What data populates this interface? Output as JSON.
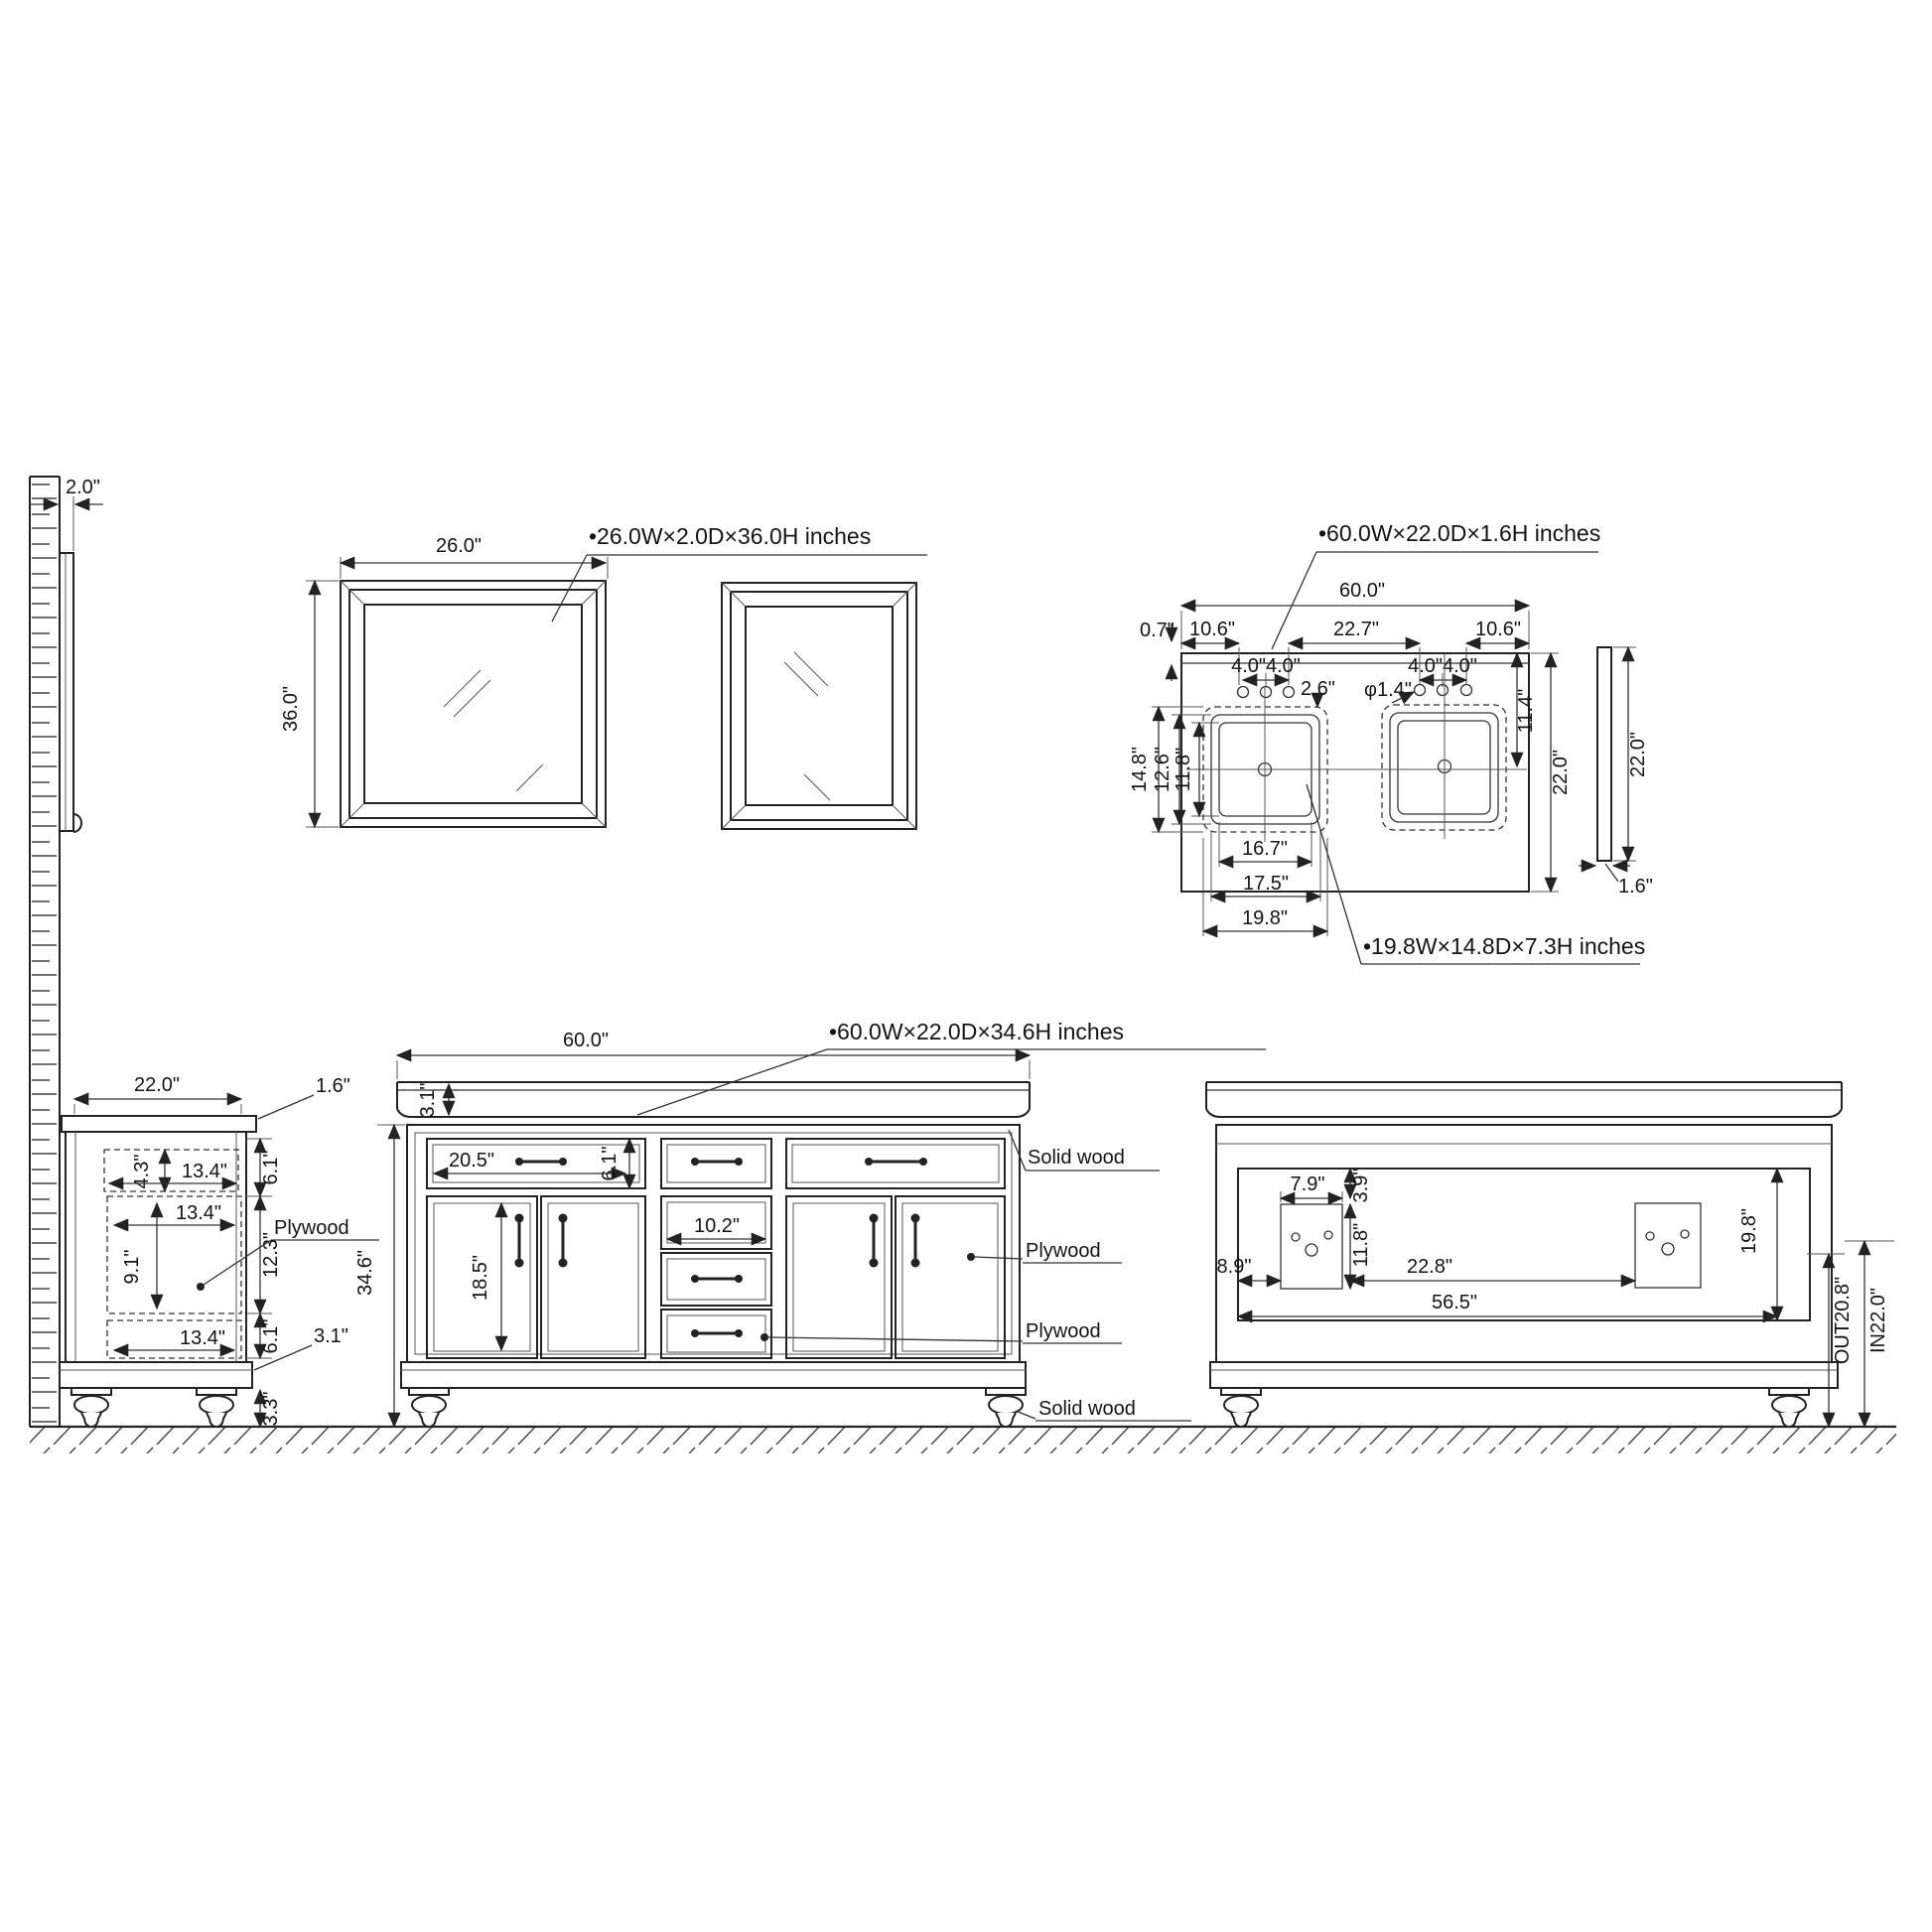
{
  "page": {
    "background": "#ffffff",
    "line_color": "#222222"
  },
  "views": {
    "wall": {
      "thickness": "2.0\""
    },
    "mirror_front": {
      "callout": "•26.0W×2.0D×36.0H inches",
      "width": "26.0\"",
      "height": "36.0\""
    },
    "countertop_plan": {
      "callout": "•60.0W×22.0D×1.6H inches",
      "width": "60.0\"",
      "back_ledge": "0.7\"",
      "left_to_holes": "10.6\"",
      "between_hole_groups": "22.7\"",
      "holes_to_right": "10.6\"",
      "hole_spacing_left": "4.0\"4.0\"",
      "hole_spacing_right": "4.0\"4.0\"",
      "hole_to_sink": "2.6\"",
      "hole_diameter": "φ1.4\"",
      "sink_setback": "11.4\"",
      "depth": "22.0\"",
      "sink_depth_outer": "14.8\"",
      "sink_depth_mid": "12.6\"",
      "sink_depth_inner": "11.8\"",
      "sink_width_inner": "16.7\"",
      "sink_width_mid": "17.5\"",
      "sink_width_outer": "19.8\"",
      "sink_callout": "•19.8W×14.8D×7.3H inches",
      "side_depth": "22.0\"",
      "side_thickness": "1.6\""
    },
    "side_view": {
      "depth": "22.0\"",
      "counter_thickness": "1.6\"",
      "drawer_height": "4.3\"",
      "drawer_width": "13.4\"",
      "mid_width": "13.4\"",
      "mid_inner_height": "9.1\"",
      "bottom_width": "13.4\"",
      "top_section": "6.1\"",
      "mid_section": "12.3\"",
      "bottom_section": "6.1\"",
      "base_height": "3.1\"",
      "foot_height": "3.3\"",
      "material": "Plywood",
      "total_height": "34.6\""
    },
    "front_view": {
      "callout": "•60.0W×22.0D×34.6H inches",
      "width": "60.0\"",
      "counter_thickness": "3.1\"",
      "top_drawer_width": "20.5\"",
      "top_drawer_height": "6.1\"",
      "middle_drawer_width": "10.2\"",
      "door_height": "18.5\"",
      "material_top": "Solid wood",
      "material_door": "Plywood",
      "material_drawer": "Plywood",
      "material_foot": "Solid wood"
    },
    "back_view": {
      "cutout_width": "7.9\"",
      "cutout_top_offset": "3.9\"",
      "cutout_height": "11.8\"",
      "left_offset": "8.9\"",
      "between_cutouts": "22.8\"",
      "opening_width": "56.5\"",
      "opening_height": "19.8\"",
      "drain_out_height": "OUT20.8\"",
      "water_in_height": "IN22.0\""
    }
  }
}
